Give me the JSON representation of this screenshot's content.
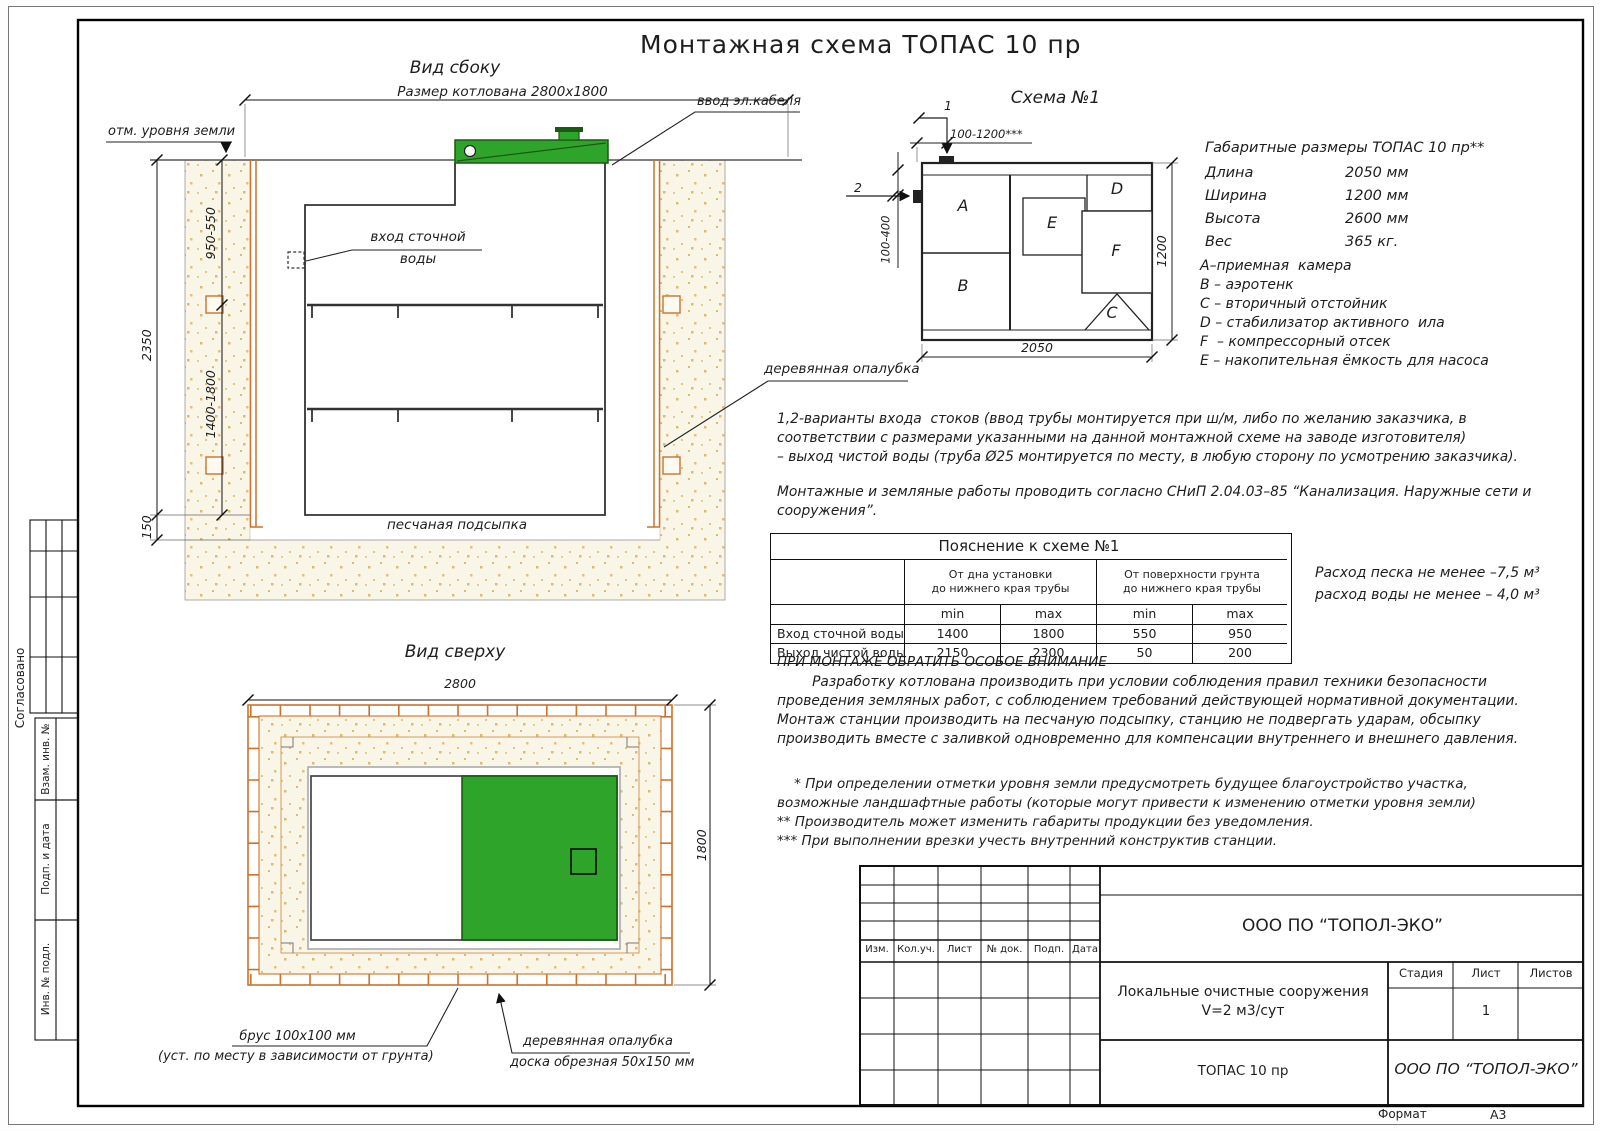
{
  "page": {
    "title": "Монтажная схема ТОПАС 10 пр",
    "format_label": "Формат",
    "format_value": "А3"
  },
  "side_view": {
    "title": "Вид сбоку",
    "pit_dim": "Размер котлована 2800x1800",
    "cable_label": "ввод эл.кабеля",
    "ground_label": "отм. уровня земли",
    "inlet_line1": "вход сточной",
    "inlet_line2": "воды",
    "sand_label": "песчаная подсыпка",
    "formwork_label": "деревянная опалубка",
    "dim_depth": "2350",
    "dim_upper": "950-550",
    "dim_lower": "1400-1800",
    "dim_bed": "150"
  },
  "schema": {
    "title": "Схема №1",
    "mark1": "1",
    "mark2": "2",
    "dim_top": "100-1200***",
    "dim_left": "100-400",
    "dim_width": "2050",
    "dim_height": "1200",
    "compartments": {
      "a": "A",
      "b": "B",
      "c": "C",
      "d": "D",
      "e": "E",
      "f": "F"
    }
  },
  "specs": {
    "heading": "Габаритные размеры ТОПАС 10 пр**",
    "rows": [
      {
        "label": "Длина",
        "value": "2050 мм"
      },
      {
        "label": "Ширина",
        "value": "1200 мм"
      },
      {
        "label": "Высота",
        "value": "2600 мм"
      },
      {
        "label": "Вес",
        "value": "365 кг."
      }
    ],
    "legend": [
      "А–приемная  камера",
      "В – аэротенк",
      "С – вторичный отстойник",
      "D – стабилизатор активного  ила",
      "F  – компрессорный отсек",
      "Е – накопительная ёмкость для насоса"
    ]
  },
  "notes": {
    "variants": [
      "1,2-варианты входа  стоков (ввод трубы монтируется при ш/м, либо по желанию заказчика, в",
      "соответствии с размерами указанными на данной монтажной схеме на заводе изготовителя)",
      "– выход чистой воды (труба Ø25 монтируется по месту, в любую сторону по усмотрению заказчика)."
    ],
    "snip": [
      "Монтажные и земляные работы проводить согласно СНиП 2.04.03–85 “Канализация. Наружные сети и",
      "сооружения”."
    ]
  },
  "explain_table": {
    "title": "Пояснение к схеме №1",
    "group1_line1": "От дна установки",
    "group1_line2": "до нижнего края трубы",
    "group2_line1": "От поверхности грунта",
    "group2_line2": "до нижнего края трубы",
    "min": "min",
    "max": "max",
    "rows": [
      {
        "name": "Вход сточной воды",
        "v1": "1400",
        "v2": "1800",
        "v3": "550",
        "v4": "950"
      },
      {
        "name": "Выход чистой воды",
        "v1": "2150",
        "v2": "2300",
        "v3": "50",
        "v4": "200"
      }
    ]
  },
  "consumption": [
    "Расход песка не менее –7,5 м³",
    "расход воды не менее – 4,0 м³"
  ],
  "attention": {
    "heading": "ПРИ МОНТАЖЕ ОБРАТИТЬ ОСОБОЕ ВНИМАНИЕ",
    "body": [
      "        Разработку котлована производить при условии соблюдения правил техники безопасности",
      "проведения земляных работ, с соблюдением требований действующей нормативной документации.",
      "Монтаж станции производить на песчаную подсыпку, станцию не подвергать ударам, обсыпку",
      "производить вместе с заливкой одновременно для компенсации внутреннего и внешнего давления."
    ],
    "footnotes": [
      "    * При определении отметки уровня земли предусмотреть будущее благоустройство участка,",
      "возможные ландшафтные работы (которые могут привести к изменению отметки уровня земли)",
      "** Производитель может изменить габариты продукции без уведомления.",
      "*** При выполнении врезки учесть внутренний конструктив станции."
    ]
  },
  "top_view": {
    "title": "Вид сверху",
    "dim_width": "2800",
    "dim_height": "1800",
    "beam_line1": "брус 100x100 мм",
    "beam_line2": "(уст. по месту в зависимости от грунта)",
    "formwork_line1": "деревянная опалубка",
    "formwork_line2": "доска обрезная 50x150 мм"
  },
  "sidebar": {
    "agreed": "Согласовано",
    "box1": "Взам. инв. №",
    "box2": "Подп. и дата",
    "box3": "Инв. № подл."
  },
  "titleblock": {
    "cols": [
      "Изм.",
      "Кол.уч.",
      "Лист",
      "№ док.",
      "Подп.",
      "Дата"
    ],
    "company": "ООО ПО “ТОПОЛ-ЭКО”",
    "project_line1": "Локальные очистные сооружения",
    "project_line2": "V=2 м3/сут",
    "stage_label": "Стадия",
    "sheet_label": "Лист",
    "sheets_label": "Листов",
    "sheet_value": "1",
    "product": "ТОПАС 10 пр",
    "company_italic": "ООО ПО “ТОПОЛ-ЭКО”"
  },
  "colors": {
    "green": "#2fa42b",
    "formwork_orange": "#c9732c",
    "sand_dot": "#ddba72"
  }
}
